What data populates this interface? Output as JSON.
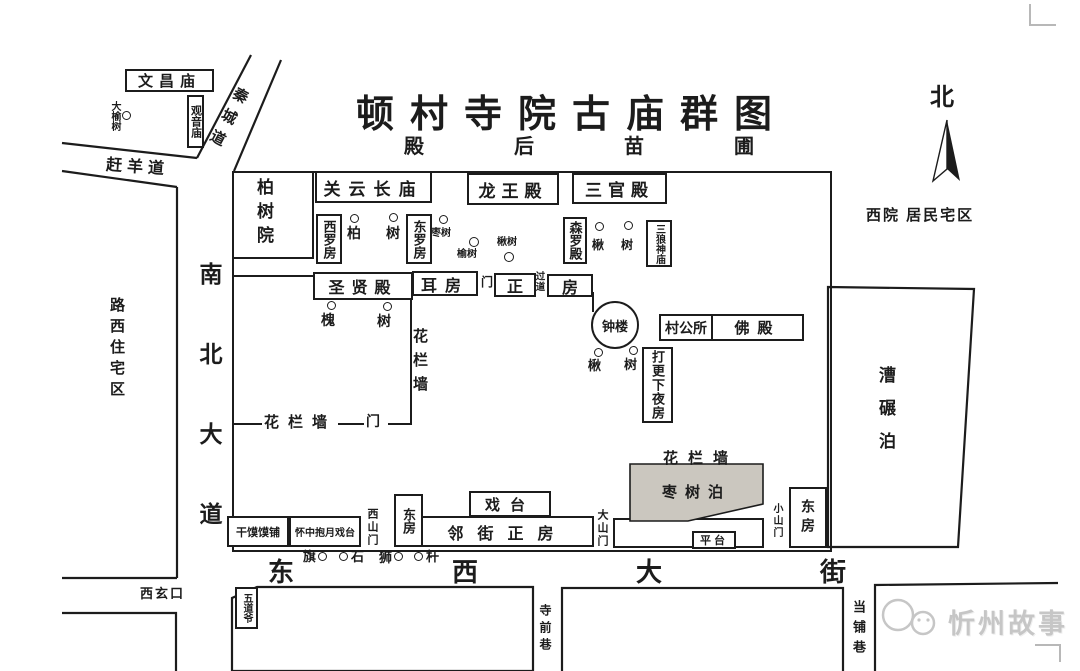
{
  "title": "顿村寺院古庙群图",
  "subtitle_area": "殿后苗圃",
  "compass_north": "北",
  "roads": {
    "qinchengdao": "秦城道",
    "ganyangdao": "赶羊道",
    "nanbei_dadao": "南北大道",
    "dongxi_dajie": "东西大街",
    "xixuankou": "西玄口",
    "siqianxiang": "寺前巷",
    "dangpuxiang": "当铺巷"
  },
  "districts": {
    "luxi_zhuzhaiqu": "路西住宅区",
    "xiyuan_jumin": "西院 居民宅区",
    "caonianbo": "漕碾泊",
    "zaoshubo": "枣树泊"
  },
  "buildings": {
    "wenchangmiao": "文昌庙",
    "guanyinmiao": "观音庙",
    "baishuyuan": "柏树院",
    "guanyunchangmiao": "关云长庙",
    "longwangdian": "龙王殿",
    "sanguandian": "三官殿",
    "xiluofang": "西罗房",
    "dongluofang": "东罗房",
    "senluodian": "森罗殿",
    "sanlangshenmiao": "三狼神庙",
    "shengxiandian": "圣贤殿",
    "erfang": "耳房",
    "men_small": "门",
    "zhengfang_left": "正",
    "guodao": "过道",
    "zhengfang_right": "房",
    "zhonglou": "钟楼",
    "cungongsuo": "村公所",
    "fodian": "佛殿",
    "dageng_xiayefang": "打更下夜房",
    "xitai": "戏台",
    "linjie_zhengfang": "邻街正房",
    "dongfang_west": "东房",
    "dongfang_east": "东房",
    "ganmomopu": "干馍馍铺",
    "huaizhong_baoyue_xitai": "怀中抱月戏台",
    "pingtai": "平台",
    "wudaoye": "五道爷"
  },
  "gates": {
    "xishanmen": "西山门",
    "dashanmen": "大山门",
    "xiaoshanmen": "小山门",
    "hualan_men": "门"
  },
  "walls": {
    "hualanqiang_west": "花栏墙",
    "hualanqiang_mid": "花栏墙",
    "hualanqiang_south": "花栏墙"
  },
  "trees": [
    {
      "label": "大榆树"
    },
    {
      "label": "柏"
    },
    {
      "label": "树"
    },
    {
      "label": "枣树"
    },
    {
      "label": "榆树"
    },
    {
      "label": "楸树"
    },
    {
      "label": "楸"
    },
    {
      "label": "树"
    },
    {
      "label": "槐"
    },
    {
      "label": "树"
    },
    {
      "label": "楸"
    },
    {
      "label": "树"
    }
  ],
  "street_objects": [
    {
      "label": "旗"
    },
    {
      "label": "石"
    },
    {
      "label": "狮"
    },
    {
      "label": "杆"
    }
  ],
  "watermark": {
    "text": "忻州故事"
  },
  "colors": {
    "ink": "#1c1c1c",
    "shade": "#cbc7bf",
    "watermark": "#c6c6c6"
  }
}
